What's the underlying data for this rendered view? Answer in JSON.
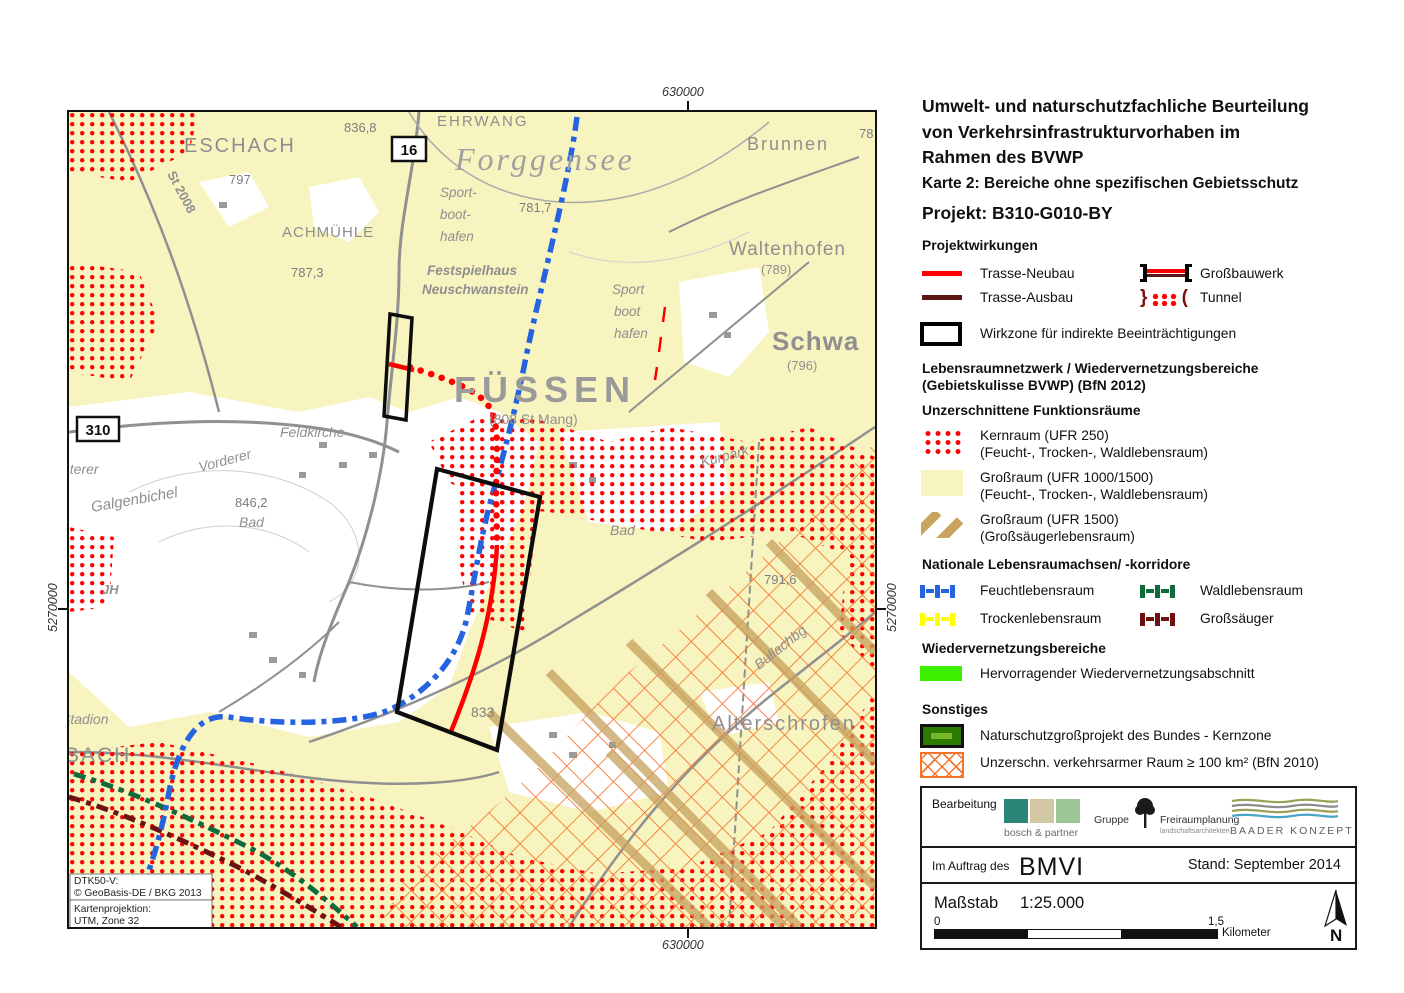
{
  "document": {
    "title_line1": "Umwelt- und naturschutzfachliche Beurteilung",
    "title_line2": "von Verkehrsinfrastrukturvorhaben im",
    "title_line3": "Rahmen des BVWP",
    "subtitle": "Karte 2: Bereiche ohne spezifischen Gebietsschutz",
    "project": "Projekt: B310-G010-BY"
  },
  "legend": {
    "projektwirkungen": {
      "heading": "Projektwirkungen",
      "trasse_neubau": "Trasse-Neubau",
      "trasse_ausbau": "Trasse-Ausbau",
      "grossbauwerk": "Großbauwerk",
      "tunnel": "Tunnel",
      "wirkzone": "Wirkzone für indirekte Beeinträchtigungen"
    },
    "netzwerk": {
      "heading_line1": "Lebensraumnetzwerk / Wiedervernetzungsbereiche",
      "heading_line2": "(Gebietskulisse BVWP) (BfN 2012)",
      "subheading": "Unzerschnittene Funktionsräume",
      "kernraum_line1": "Kernraum (UFR 250)",
      "kernraum_line2": "(Feucht-, Trocken-, Waldlebensraum)",
      "grossraum1_line1": "Großraum (UFR 1000/1500)",
      "grossraum1_line2": "(Feucht-, Trocken-, Waldlebensraum)",
      "grossraum2_line1": "Großraum (UFR 1500)",
      "grossraum2_line2": "(Großsäugerlebensraum)"
    },
    "achsen": {
      "heading": "Nationale Lebensraumachsen/ -korridore",
      "feucht": "Feuchtlebensraum",
      "wald": "Waldlebensraum",
      "trocken": "Trockenlebensraum",
      "grosssaeuger": "Großsäuger"
    },
    "wiedervernetzung": {
      "heading": "Wiedervernetzungsbereiche",
      "item": "Hervorragender Wiedervernetzungsabschnitt"
    },
    "sonstiges": {
      "heading": "Sonstiges",
      "naturschutz": "Naturschutzgroßprojekt des Bundes - Kernzone",
      "verkehrsarm": "Unzerschn. verkehrsarmer Raum ≥ 100 km² (BfN 2010)"
    }
  },
  "footer": {
    "bearbeitung_label": "Bearbeitung",
    "logo_bosch": "bosch & partner",
    "logo_gruppe_line1": "Gruppe",
    "logo_gruppe_line2": "Freiraumplanung",
    "logo_gruppe_line3": "landschaftsarchitekten",
    "logo_baader": "BAADER KONZEPT",
    "auftrag_label": "Im Auftrag des",
    "auftrag_client": "BMVI",
    "stand": "Stand: September 2014",
    "massstab_label": "Maßstab",
    "massstab_value": "1:25.000",
    "scale_zero": "0",
    "scale_end": "1,5",
    "scale_unit": "Kilometer",
    "north_label": "N"
  },
  "map": {
    "coordinates": {
      "top": "630000",
      "bottom": "630000",
      "left": "5270000",
      "right": "5270000"
    },
    "labels": {
      "eschach": "ESCHACH",
      "st2008": "St 2008",
      "spot_797": "797",
      "spot_836_8": "836,8",
      "ehrwang": "EHRWANG",
      "b16": "16",
      "forggensee": "Forggensee",
      "brunnen": "Brunnen",
      "spot_78": "78",
      "sport1_line1": "Sport-",
      "sport1_line2": "boot-",
      "sport1_line3": "hafen",
      "achmuehle": "ACHMÜHLE",
      "spot_787_3": "787,3",
      "festspielhaus_line1": "Festspielhaus",
      "festspielhaus_line2": "Neuschwanstein",
      "spot_781_7": "781,7",
      "sport2_line1": "Sport",
      "sport2_line2": "boot",
      "sport2_line3": "hafen",
      "waltenhofen": "Waltenhofen",
      "waltenhofen_elev": "(789)",
      "schwangau": "Schwa",
      "schwangau_elev": "(796)",
      "fuessen": "FÜSSEN",
      "fuessen_sub": "(808 St Mang)",
      "b310": "310",
      "hinterer": "nterer",
      "feldkirche": "Feldkirche",
      "vorderer": "Vorderer",
      "galgenbichel": "Galgenbichel",
      "spot_846_2": "846,2",
      "bad1": "Bad",
      "jh": "JH",
      "kurpark": "Kurpark",
      "bad2": "Bad",
      "spot_791_6": "791,6",
      "bullachberg": "Bullachbg",
      "alterschrofen": "Alterschrofen",
      "spot_833": "833",
      "stadion": "Stadion",
      "bach": "BACH"
    },
    "credits": {
      "line1": "DTK50-V:",
      "line2": "© GeoBasis-DE / BKG 2013",
      "line3": "Kartenprojektion:",
      "line4": "UTM, Zone 32"
    }
  },
  "colors": {
    "trasse_neubau": "#ff0000",
    "trasse_ausbau": "#5a1713",
    "kernraum": "#ff0000",
    "grossraum_ufr1000": "#f8f4c0",
    "grossraum_ufr1500": "#c8a45f",
    "feuchtlebensraum": "#2563e0",
    "waldlebensraum": "#0f6b3c",
    "trockenlebensraum": "#ffff00",
    "grosssaeuger": "#6e1111",
    "wiedervernetzung": "#3cf000",
    "naturschutz_kernzone": "#2d7a00",
    "verkehrsarmer_raum": "#f4742c"
  }
}
